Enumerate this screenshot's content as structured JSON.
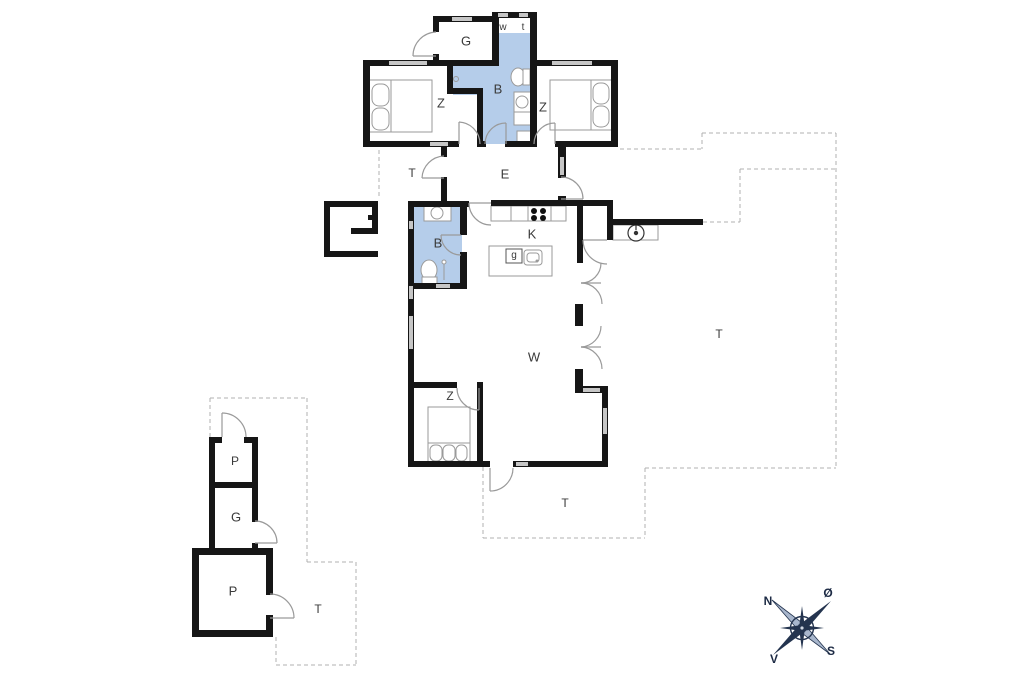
{
  "plan": {
    "rooms": [
      {
        "id": "annex-room",
        "label": "G"
      },
      {
        "id": "w-closet",
        "label": "w"
      },
      {
        "id": "t-toilet",
        "label": "t"
      },
      {
        "id": "bedroom-left",
        "label": "Z"
      },
      {
        "id": "bathroom-top",
        "label": "B"
      },
      {
        "id": "bedroom-right",
        "label": "Z"
      },
      {
        "id": "terrace-west",
        "label": "T"
      },
      {
        "id": "entry-hall",
        "label": "E"
      },
      {
        "id": "bathroom-main",
        "label": "B"
      },
      {
        "id": "kitchen",
        "label": "K"
      },
      {
        "id": "island-unit",
        "label": "g"
      },
      {
        "id": "living-room",
        "label": "W"
      },
      {
        "id": "terrace-east",
        "label": "T"
      },
      {
        "id": "bedroom-south",
        "label": "Z"
      },
      {
        "id": "terrace-south",
        "label": "T"
      },
      {
        "id": "outbuilding-room-top",
        "label": "P"
      },
      {
        "id": "outbuilding-garage",
        "label": "G"
      },
      {
        "id": "outbuilding-room-big",
        "label": "P"
      },
      {
        "id": "terrace-outbuilding",
        "label": "T"
      }
    ],
    "compass": {
      "north": "N",
      "east": "Ø",
      "south": "S",
      "west": "V"
    },
    "colors": {
      "wall": "#161616",
      "window": "#c6c6c6",
      "bathroom_fill": "#b5cdea",
      "dashed_line": "#b0b0b0",
      "door_arc": "#9a9a9a",
      "compass_dark": "#24344f",
      "compass_light": "#a8b6cc",
      "label_text": "#3a3a3a"
    }
  }
}
